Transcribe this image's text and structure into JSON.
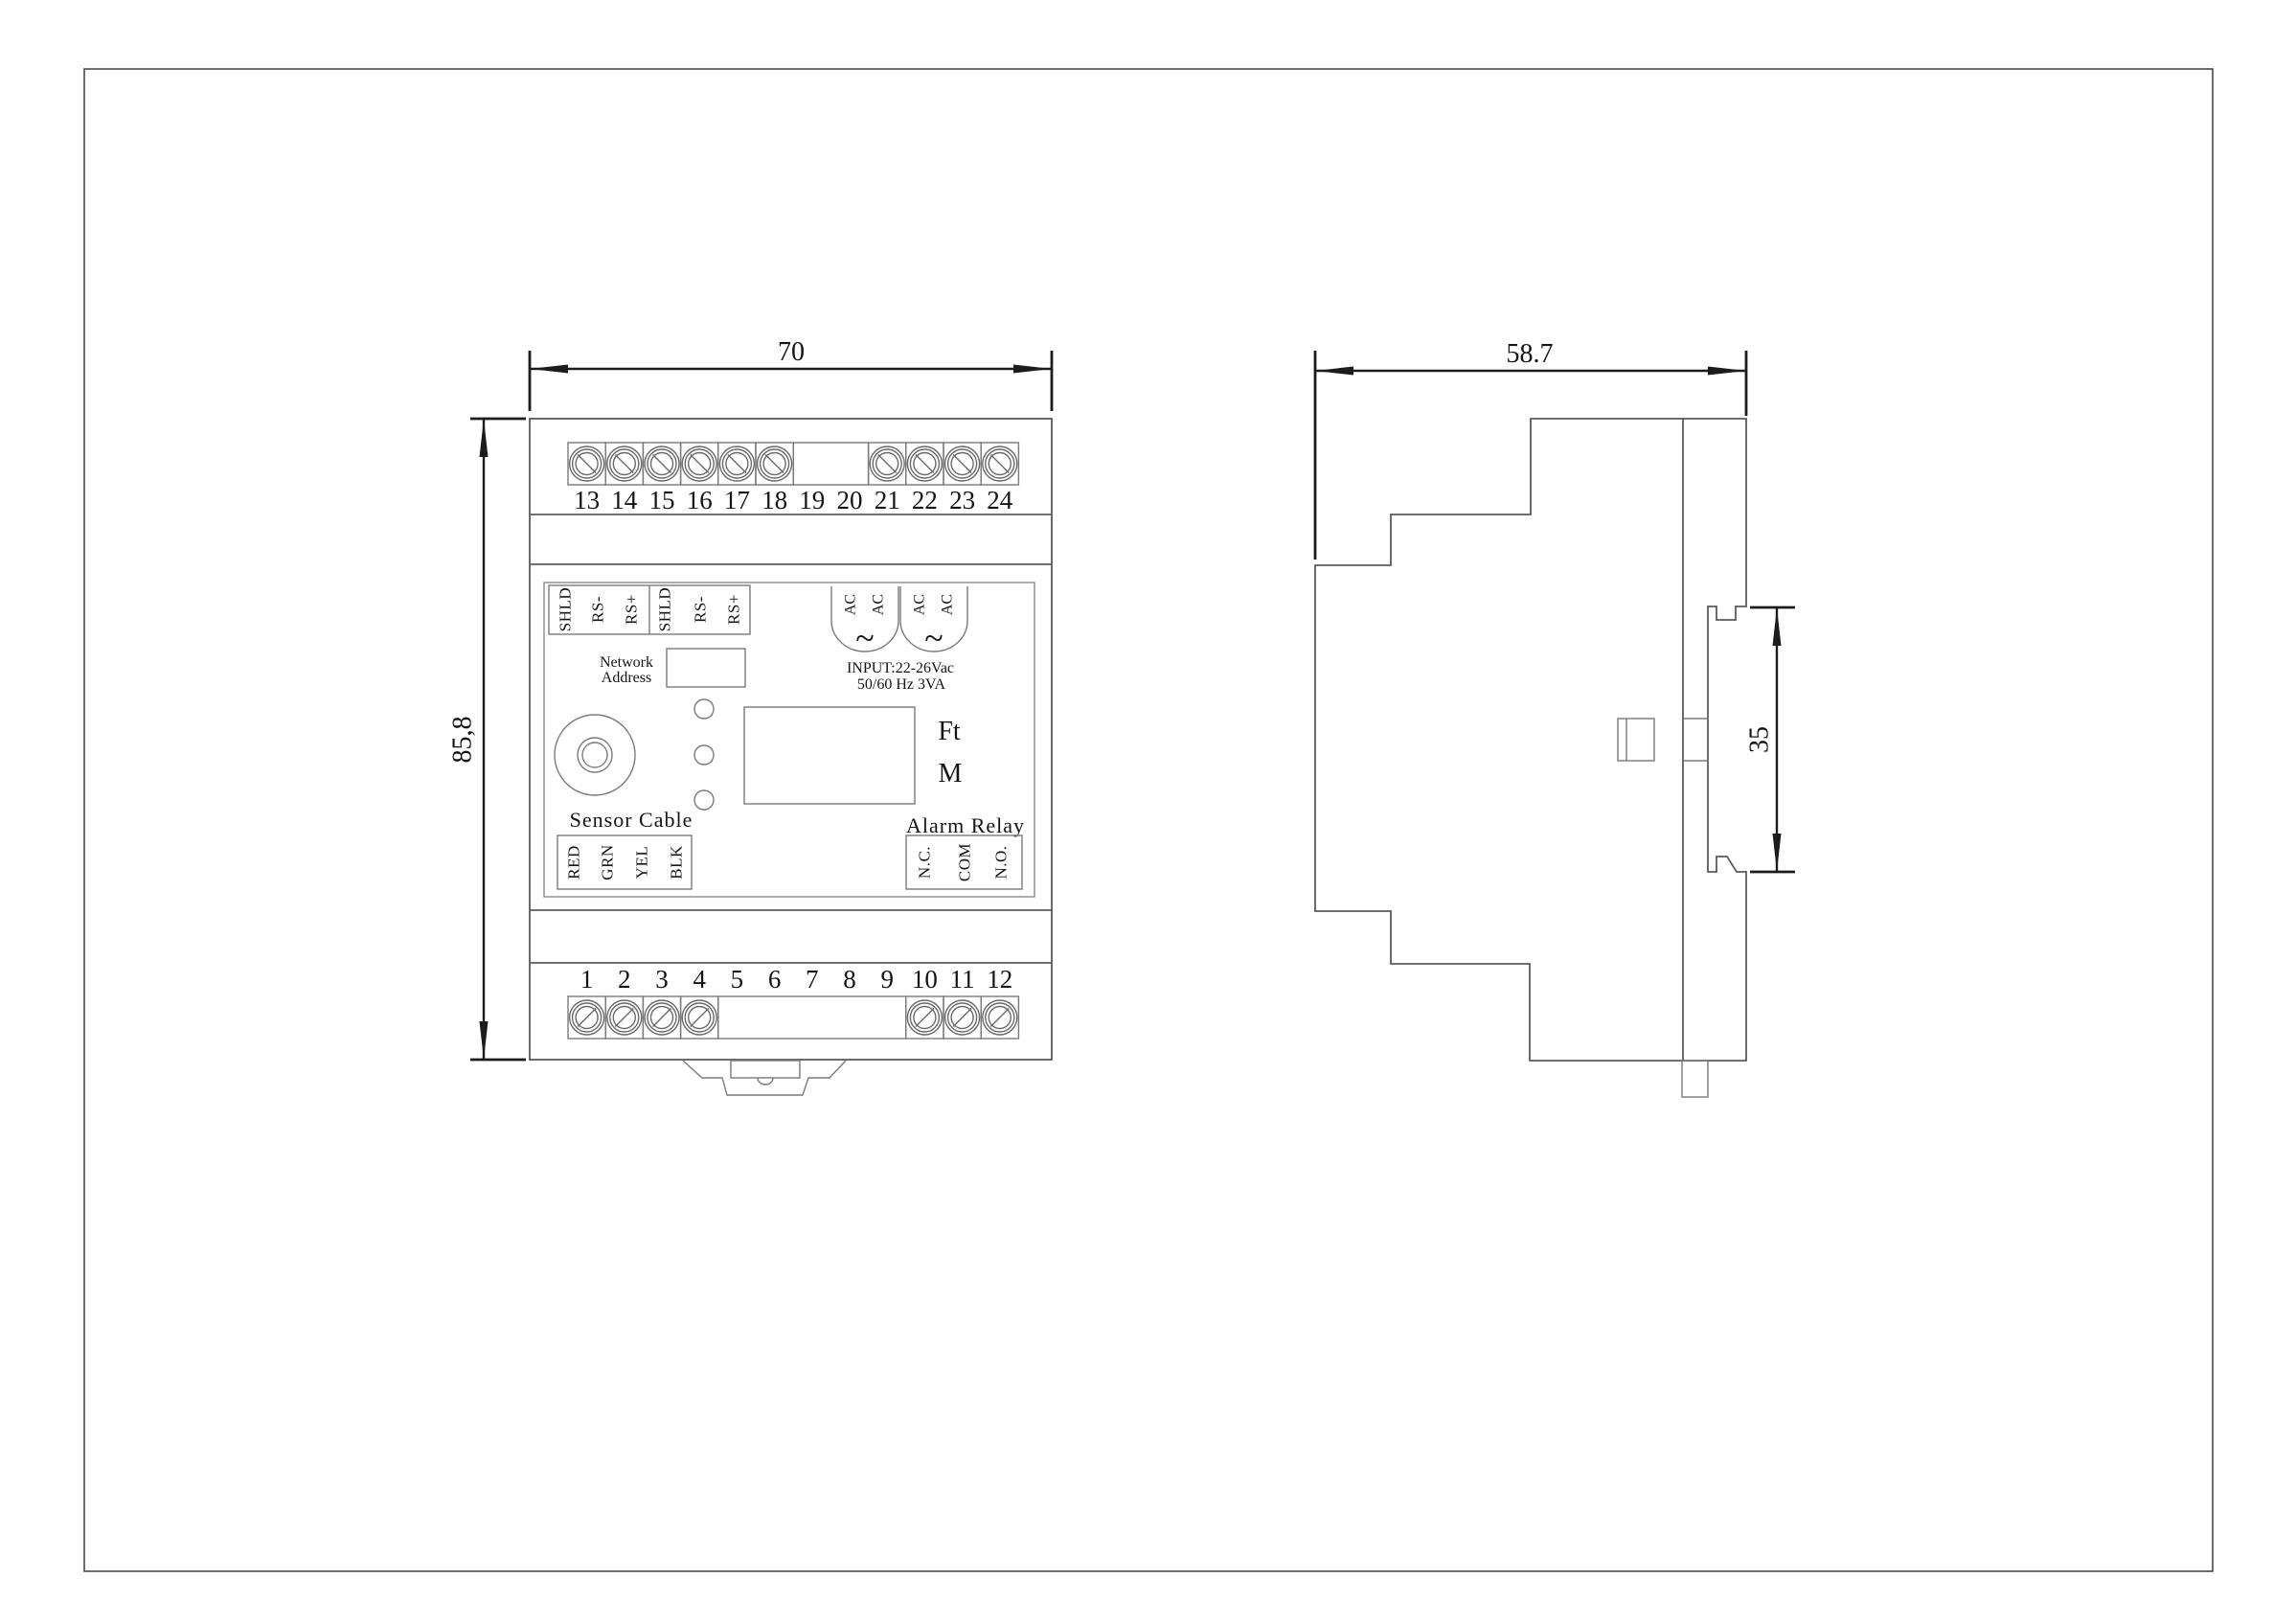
{
  "page": {
    "background": "#ffffff",
    "line_color": "#5b5b5b",
    "dimension_color": "#1c1c1c"
  },
  "dimensions": {
    "front_width_mm": "70",
    "front_height_mm": "85,8",
    "side_depth_mm": "58.7",
    "din_rail_mm": "35"
  },
  "front_view": {
    "top_terminal_labels": [
      "13",
      "14",
      "15",
      "16",
      "17",
      "18",
      "19",
      "20",
      "21",
      "22",
      "23",
      "24"
    ],
    "bottom_terminal_labels": [
      "1",
      "2",
      "3",
      "4",
      "5",
      "6",
      "7",
      "8",
      "9",
      "10",
      "11",
      "12"
    ],
    "comm_terminal_labels": [
      "SHLD",
      "RS-",
      "RS+",
      "SHLD",
      "RS-",
      "RS+"
    ],
    "network_address_line1": "Network",
    "network_address_line2": "Address",
    "power_terminal_labels": [
      "AC",
      "AC",
      "AC",
      "AC"
    ],
    "power_symbol": "~",
    "power_input_line1": "INPUT:22-26Vac",
    "power_input_line2": "50/60 Hz 3VA",
    "unit_label_1": "Ft",
    "unit_label_2": "M",
    "sensor_cable_label": "Sensor Cable",
    "sensor_wire_labels": [
      "RED",
      "GRN",
      "YEL",
      "BLK"
    ],
    "alarm_relay_label": "Alarm Relay",
    "relay_terminal_labels": [
      "N.C.",
      "COM",
      "N.O."
    ]
  }
}
